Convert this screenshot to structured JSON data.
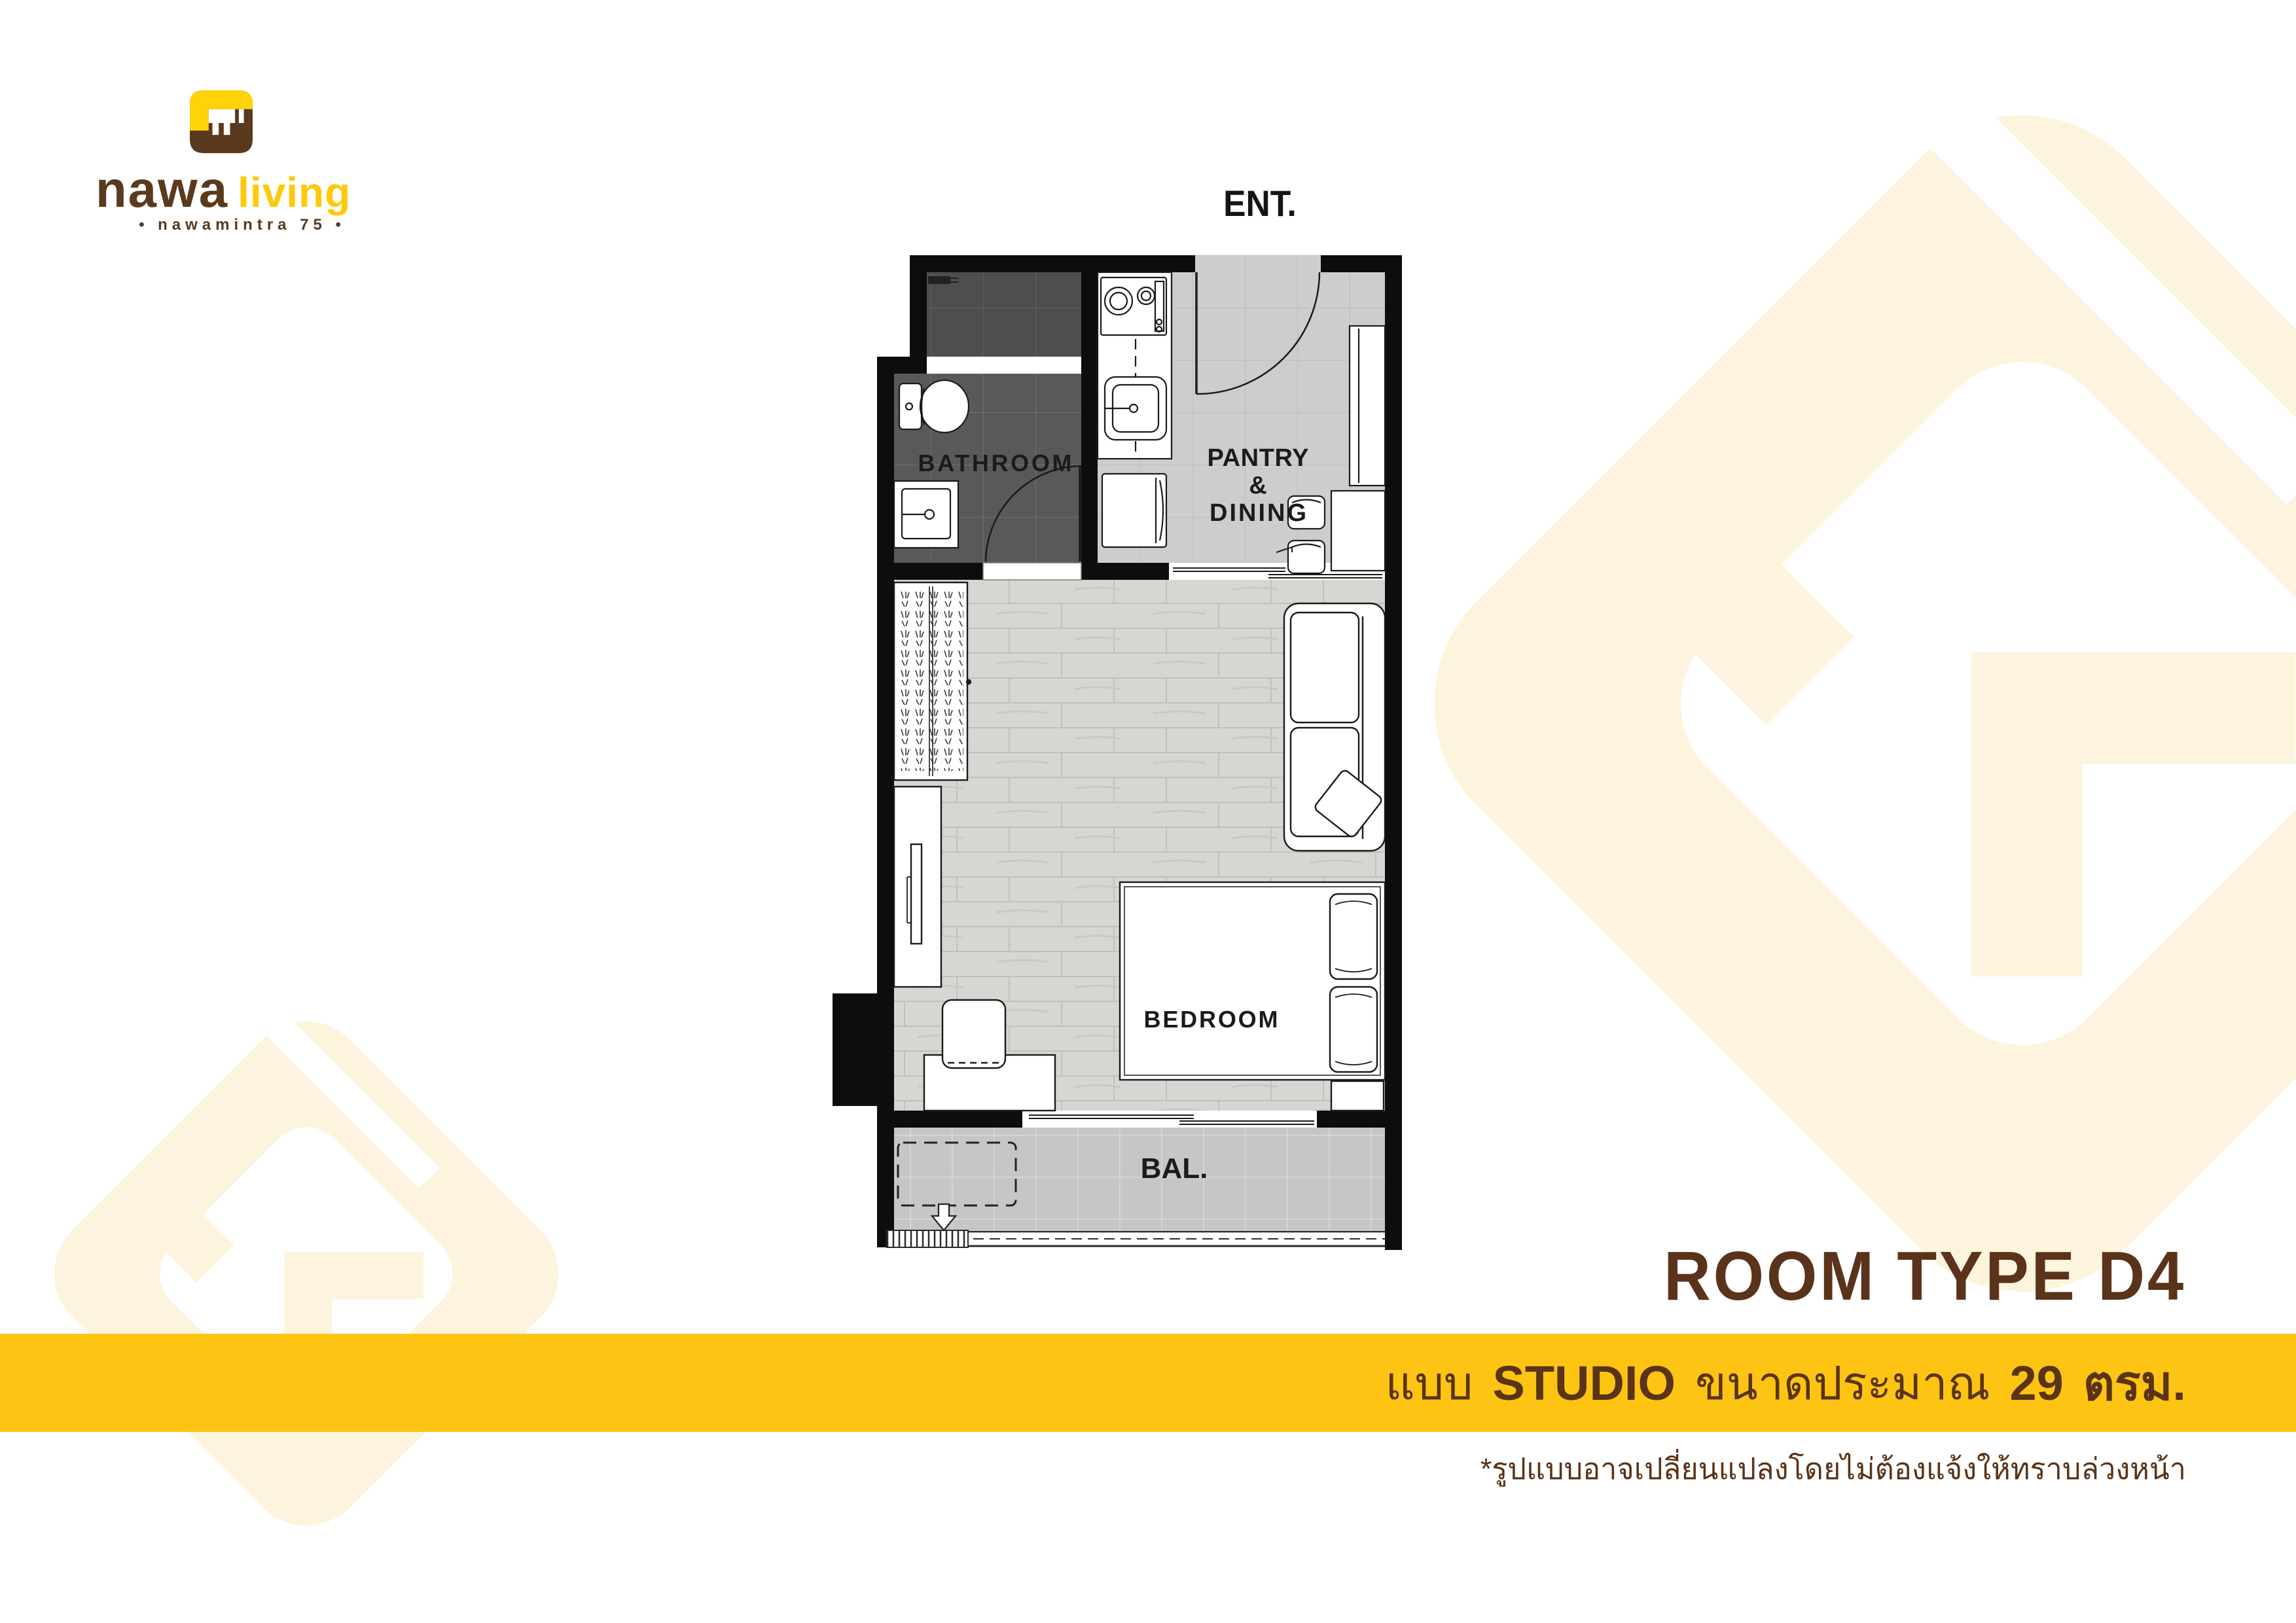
{
  "brand": {
    "name": "nawa",
    "suffix": "living",
    "tagline": "nawamintra 75",
    "tagline_display": "• nawamintra 75 •"
  },
  "plan": {
    "entrance_label": "ENT.",
    "rooms": {
      "bathroom": "BATHROOM",
      "pantry_line1": "PANTRY",
      "pantry_line2": "&",
      "pantry_line3": "DINING",
      "bedroom": "BEDROOM",
      "balcony": "BAL."
    }
  },
  "summary": {
    "title": "ROOM TYPE D4",
    "type_prefix": "แบบ",
    "type_value": "STUDIO",
    "size_label": "ขนาดประมาณ",
    "size_value": "29",
    "size_unit": "ตรม.",
    "disclaimer": "*รูปแบบอาจเปลี่ยนแปลงโดยไม่ต้องแจ้งให้ทราบล่วงหน้า"
  },
  "colors": {
    "brand_brown": "#5a391c",
    "brand_yellow": "#ffd20a",
    "banner_yellow": "#fdc414",
    "motif_cream": "#fcf4dc",
    "wall_black": "#0d0d0d"
  }
}
